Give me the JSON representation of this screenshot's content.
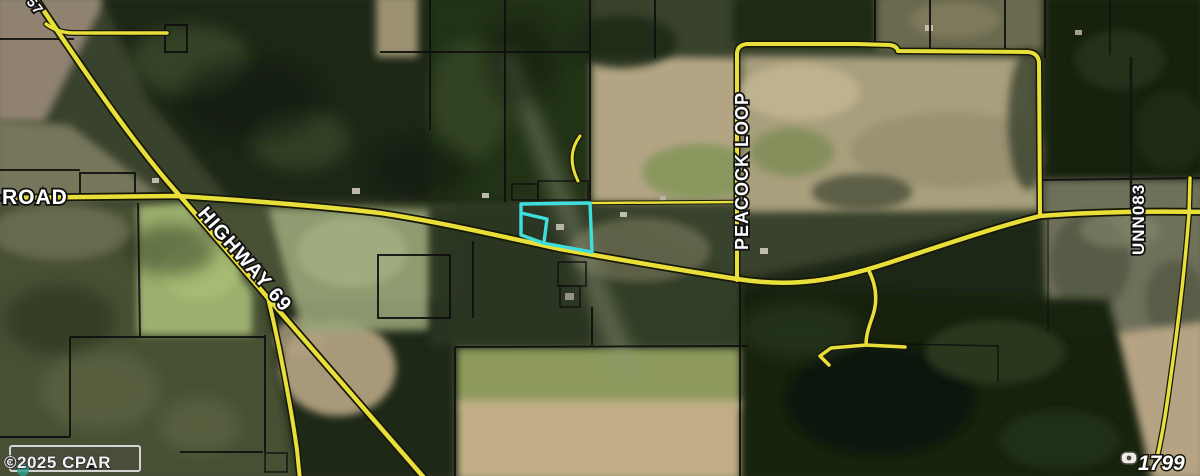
{
  "map": {
    "road_labels": {
      "west_road_partial": "-ROAD",
      "highway": "HIGHWAY 69",
      "peacock_loop": "PEACOCK LOOP",
      "unnamed_road": "UNN083",
      "top_corner_partial": "57"
    },
    "parcel": {
      "number": "1799"
    },
    "watermark": {
      "copyright": "©2025 CPAR"
    },
    "colors": {
      "road_yellow": "#e8df3a",
      "boundary_black": "#0f0f0f",
      "highlight_cyan": "#3fdede",
      "label_white": "#ffffff"
    }
  },
  "widget": {
    "collapse_icon": "▲"
  }
}
